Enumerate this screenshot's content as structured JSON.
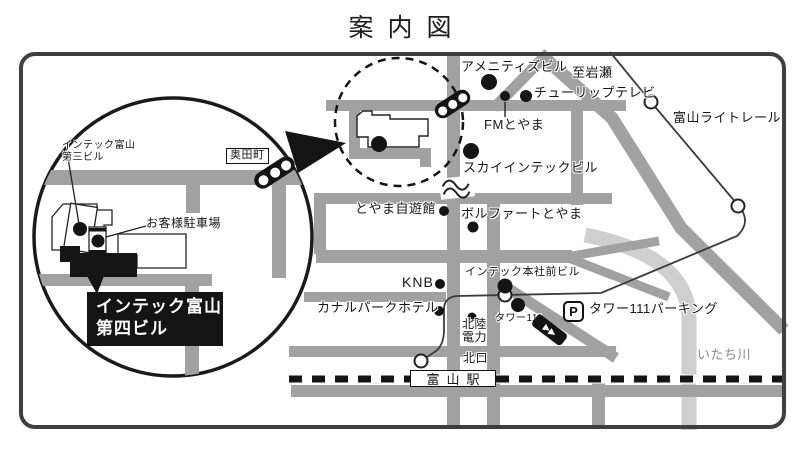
{
  "title": "案内図",
  "colors": {
    "road_gray": "#a1a1a1",
    "river_gray": "#cfcfcf",
    "line_black": "#1a1a1a"
  },
  "magnifier": {
    "building3": "インテック富山\n第三ビル",
    "okudamachi": "奥田町",
    "customer_parking": "お客様駐車場",
    "building4": "インテック富山\n第四ビル"
  },
  "places": {
    "amenities_bldg": "アメニティズビル",
    "to_iwase": "至岩瀬",
    "tulip_tv": "チューリップテレビ",
    "fm_toyama": "FMとやま",
    "toyama_light_rail": "富山ライトレール",
    "sky_intec_bldg": "スカイインテックビル",
    "toyama_jiyukan": "とやま自遊館",
    "volfahrt_toyama": "ボルファートとやま",
    "knb": "KNB",
    "intec_hq_front_bldg": "インテック本社前ビル",
    "canal_park_hotel": "カナルパークホテル",
    "tower_111": "タワー111",
    "hokuriku_electric": "北陸\n電力",
    "parking_p": "P",
    "tower_111_parking": "タワー111パーキング",
    "north_exit": "北口",
    "toyama_station": "富山駅",
    "itachi_river": "いたち川"
  }
}
